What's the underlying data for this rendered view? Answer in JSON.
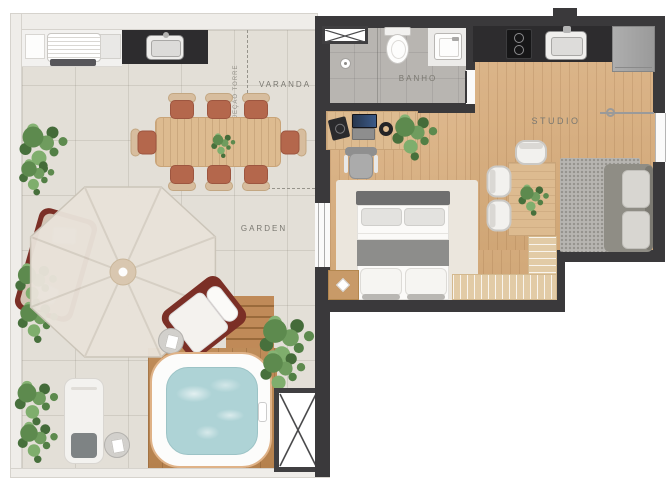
{
  "labels": {
    "varanda": "VARANDA",
    "garden": "GARDEN",
    "banho": "BANHO",
    "studio": "STUDIO",
    "projecao_torre": "PROJEÇÃO TORRE"
  },
  "colors": {
    "bg": "#ffffff",
    "wall_dark": "#3a393b",
    "wall_light": "#efede9",
    "terrace_tile": "#e3dfd7",
    "wood_floor": "#d9b184",
    "bath_tile": "#b8b5b1",
    "counter_dark": "#2d2c2e",
    "furniture_wood": "#ddbb90",
    "chair_terracotta": "#b4674c",
    "lounge_maroon": "#7b2f26",
    "water_aqua": "#aed3d6",
    "plant_green": "#5d8a4e",
    "rug_cream": "#ebe6dd",
    "sofa_gray": "#8f8d85",
    "label_gray": "#7a7871"
  }
}
